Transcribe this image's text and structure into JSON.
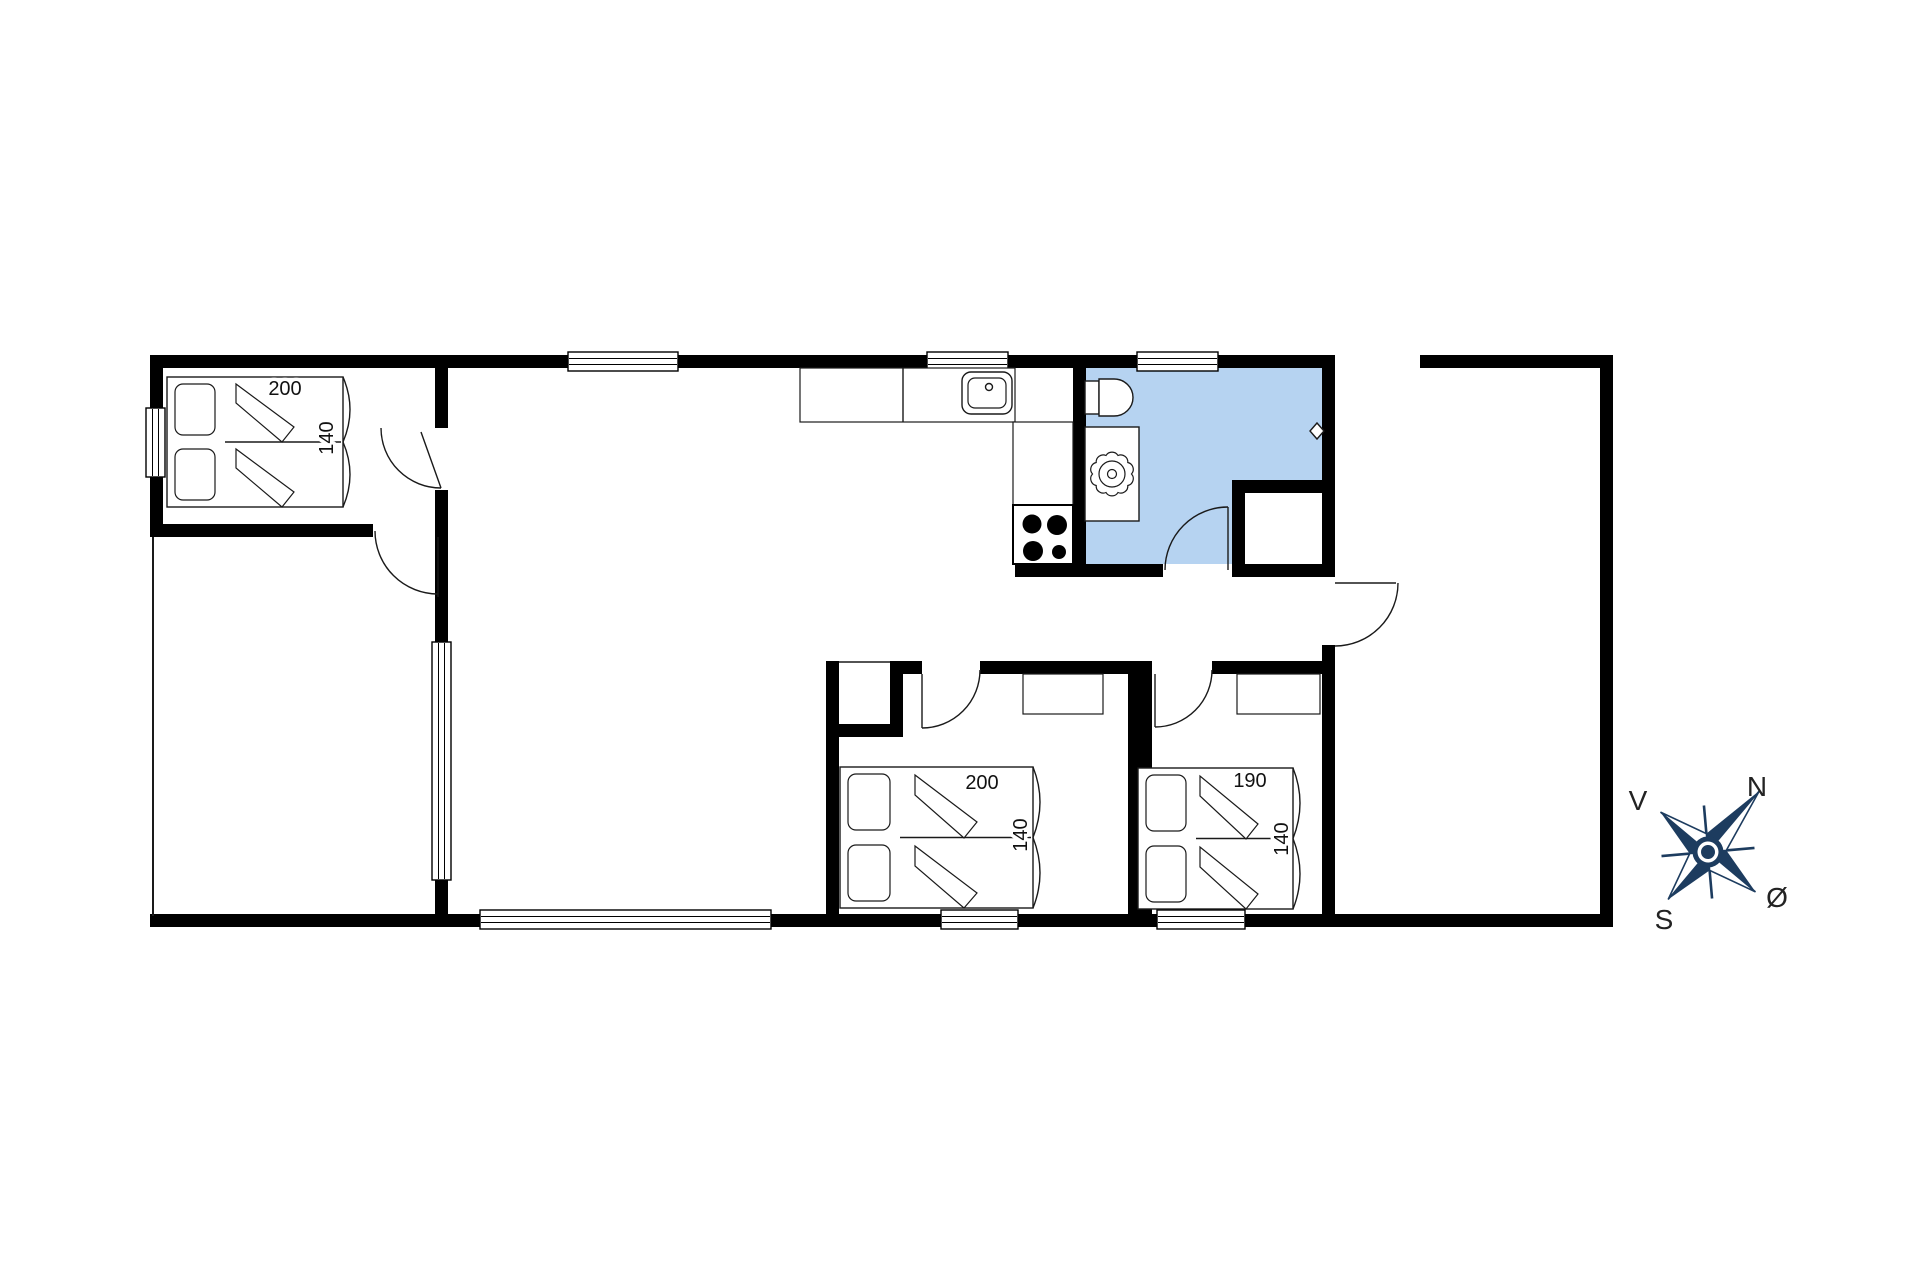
{
  "figure": "holiday-house-floor-plan",
  "colors": {
    "wall": "#000000",
    "line": "#1a1a1a",
    "bathroom_fill": "#b6d3f1",
    "compass": "#1d3c5f",
    "label_text": "#111111"
  },
  "beds": [
    {
      "position": "top-left-bedroom",
      "length_label": "200",
      "width_label": "140"
    },
    {
      "position": "bottom-middle-bedroom",
      "length_label": "200",
      "width_label": "140"
    },
    {
      "position": "bottom-right-bedroom",
      "length_label": "190",
      "width_label": "140"
    }
  ],
  "compass": {
    "north": "N",
    "east": "Ø",
    "south": "S",
    "west": "V"
  }
}
